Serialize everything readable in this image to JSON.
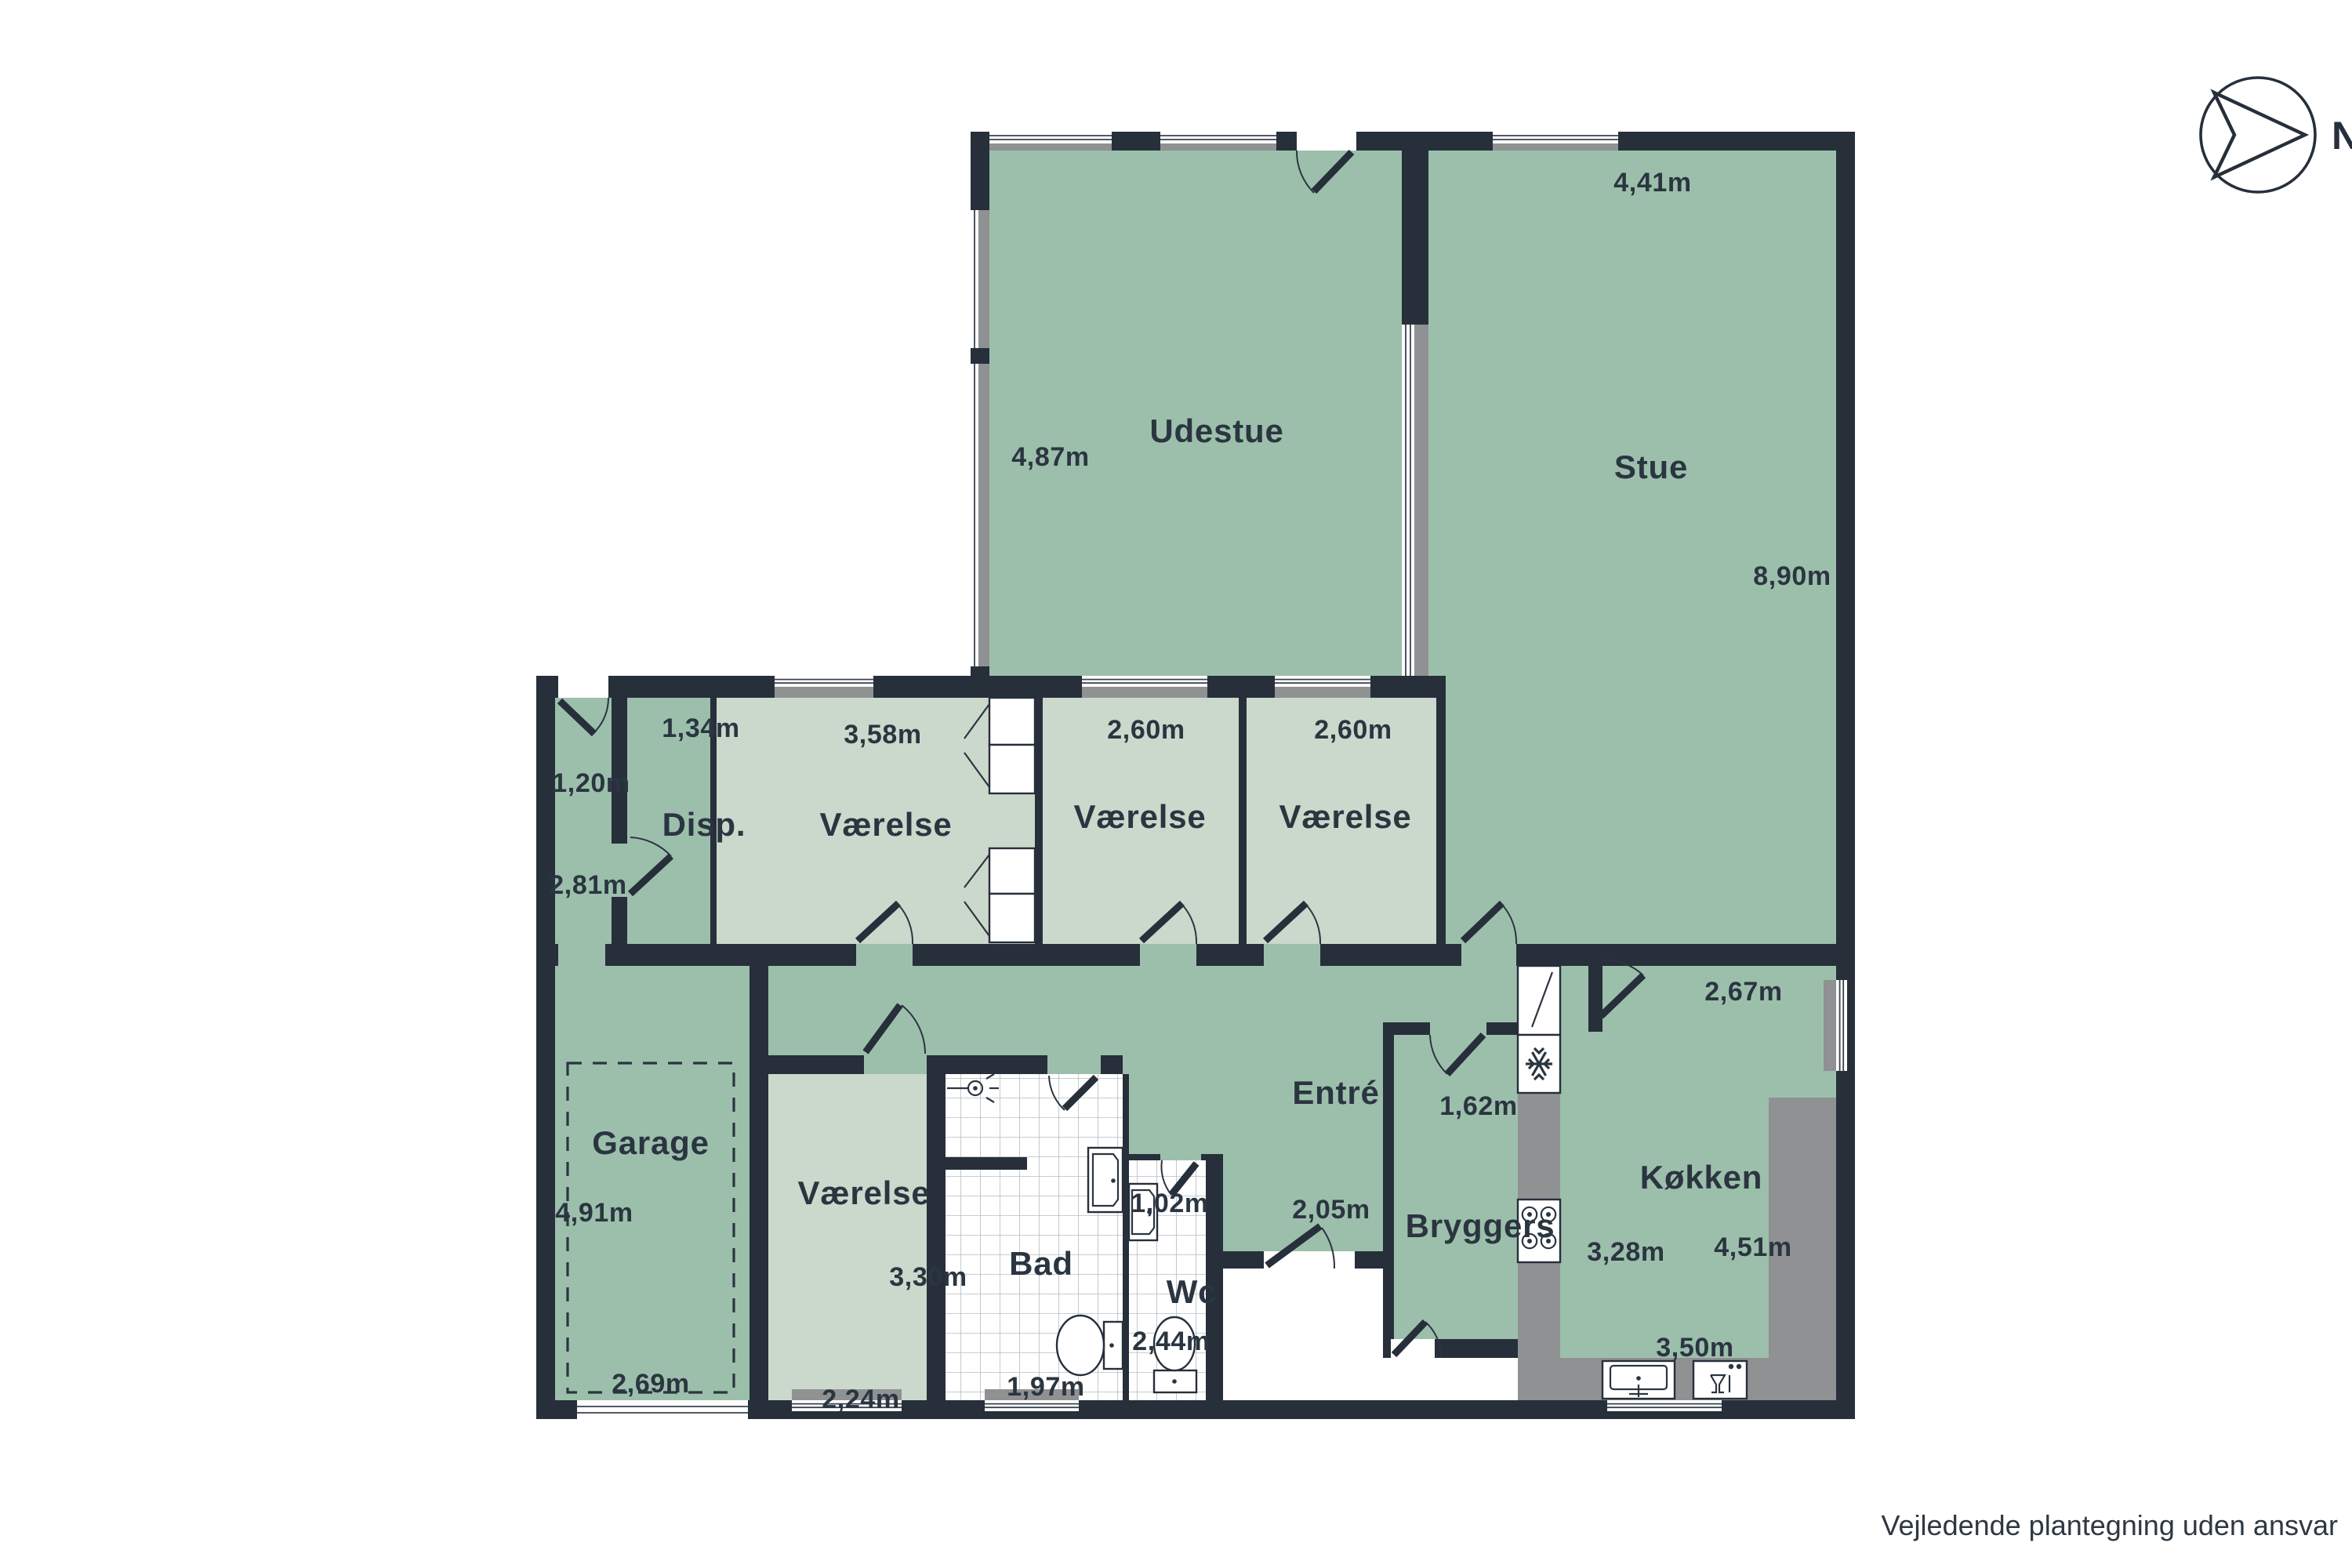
{
  "footer": {
    "note": "Vejledende plantegning uden ansvar"
  },
  "compass": {
    "label": "N"
  },
  "colors": {
    "wall": "#262f3a",
    "floor_green": "#9cbfab",
    "floor_light_green": "#cbd8cc",
    "counter_gray": "#8f9192",
    "tile_line": "#b5bdc2",
    "text": "#2b3540"
  },
  "rooms": {
    "udestue": {
      "name": "Udestue",
      "depth": "4,87m"
    },
    "stue": {
      "name": "Stue",
      "width": "4,41m",
      "depth": "8,90m"
    },
    "disp": {
      "name": "Disp.",
      "width": "1,34m"
    },
    "vaerelse_1": {
      "name": "Værelse",
      "width": "3,58m"
    },
    "vaerelse_2": {
      "name": "Værelse",
      "width": "2,60m"
    },
    "vaerelse_3": {
      "name": "Værelse",
      "width": "2,60m"
    },
    "gang": {
      "width": "1,20m",
      "depth": "2,81m"
    },
    "garage": {
      "name": "Garage",
      "depth": "4,91m",
      "width": "2,69m"
    },
    "vaerelse_4": {
      "name": "Værelse",
      "depth": "3,30m",
      "width": "2,24m"
    },
    "bad": {
      "name": "Bad",
      "width": "1,97m"
    },
    "wc": {
      "name": "Wc",
      "width": "1,02m",
      "depth": "2,44m"
    },
    "entre": {
      "name": "Entré",
      "width": "2,05m"
    },
    "bryggers": {
      "name": "Bryggers",
      "width": "1,62m"
    },
    "koekken": {
      "name": "Køkken",
      "width_top": "2,67m",
      "depth": "3,28m",
      "width": "4,51m",
      "width_bottom": "3,50m"
    }
  }
}
